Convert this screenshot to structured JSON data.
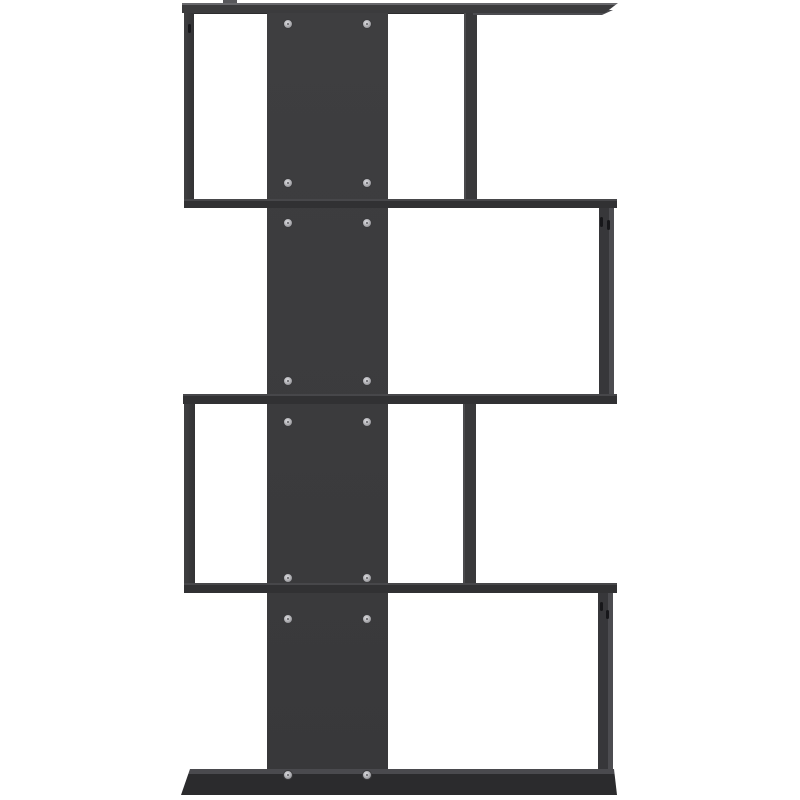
{
  "colors": {
    "background": "#ffffff",
    "panel": "#3b3b3d",
    "panel_light_edge": "#68686c",
    "shelf_band": "#313133",
    "shelf_top_edge": "#47474a",
    "underside_shadow": "#2c2c2e",
    "side_face_light": "#4c4c50",
    "base": "#2b2b2d",
    "base_top": "#4a4a4e",
    "screw_light": "#d0d0d4",
    "screw_mid": "#a9a9ad",
    "screw_dark": "#7c7c80",
    "cam_hole": "#17171a"
  },
  "screws": {
    "columns_x": [
      288,
      367
    ],
    "rows_y": [
      24,
      183,
      223,
      381,
      422,
      578,
      619,
      775
    ],
    "diameter": 10
  },
  "cam_holes": [
    {
      "x": 188,
      "y": 24,
      "w": 3,
      "h": 9
    },
    {
      "x": 600,
      "y": 217,
      "w": 3,
      "h": 10
    },
    {
      "x": 607,
      "y": 220,
      "w": 3,
      "h": 10
    },
    {
      "x": 600,
      "y": 602,
      "w": 3,
      "h": 9
    },
    {
      "x": 606,
      "y": 610,
      "w": 3,
      "h": 9
    }
  ]
}
